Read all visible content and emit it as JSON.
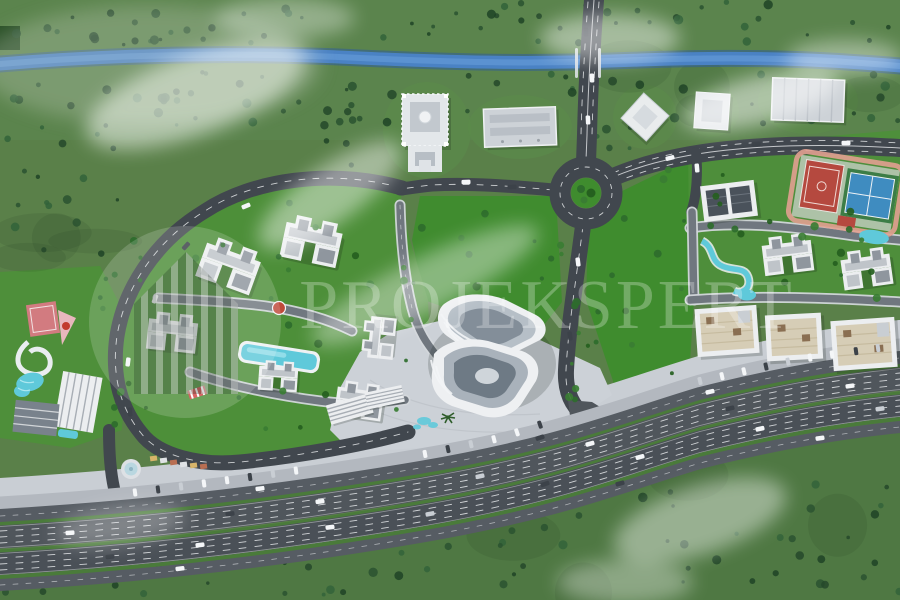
{
  "scene": {
    "title": "aerial-masterplan-render",
    "watermark": {
      "text": "PROJEKSPERT",
      "logo": "house-circle-emblem"
    },
    "colors": {
      "grass": "#5a8049",
      "grassDark": "#4e7742",
      "field": "#3f8c2e",
      "lawn": "#4c9038",
      "forest": "#2a5230",
      "river": "#4a82c4",
      "riverDeep": "#2f5d9a",
      "riverLight": "#6aa0dc",
      "asphalt": "#41474e",
      "asphaltLight": "#50565c",
      "service": "#565c63",
      "roadLight": "#70777f",
      "sidewalk": "#d3d7db",
      "promenade": "#c9ced4",
      "plaza": "#ccd1d7",
      "median": "#4a7b3a",
      "building": "#eceef0",
      "roofGrey": "#bfc4c9",
      "roofDark": "#8f969e",
      "roofTan": "#d6cdb6",
      "pool": "#5fc9da",
      "courtRed": "#b5493f",
      "courtBlue": "#3f8cc0",
      "courtGreen": "#3c7d46",
      "trackPink": "#e2a091",
      "carWhite": "#f4f6f8",
      "carDark": "#3c4249",
      "carSilver": "#c9ced4",
      "laneMark": "#e8eaec",
      "watermark": "rgba(255,255,255,0.27)"
    },
    "features": [
      "river",
      "bridge",
      "roundabout",
      "arterial-roads",
      "residential-loop-road",
      "apartment-clusters",
      "swimming-pool",
      "playground",
      "commercial-complex",
      "plaza",
      "waterpark",
      "sports-courts",
      "tennis-court",
      "running-track",
      "lazy-river",
      "retail-row",
      "highway",
      "service-roads",
      "parking-strip",
      "landmark-mosque",
      "warehouse-buildings",
      "forest",
      "clouds"
    ]
  }
}
